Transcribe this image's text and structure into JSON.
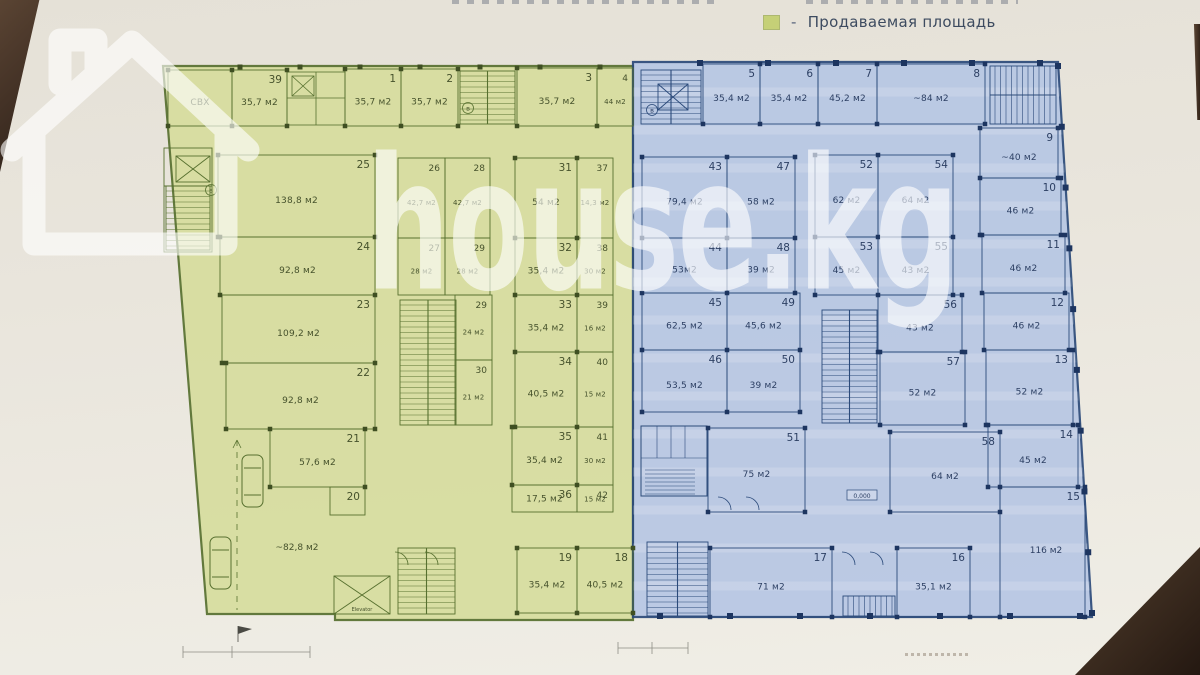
{
  "watermark": {
    "text": "house.kg"
  },
  "legend": {
    "dash": "-",
    "label": "Продаваемая площадь",
    "swatch_color": "#c5d077"
  },
  "plan": {
    "area_unit": "м2",
    "zone_colors": {
      "green_fill": "#d7dd9e",
      "green_line": "#57702f",
      "green_text": "#46522c",
      "blue_fill": "#b7c7e4",
      "blue_line": "#2b4a7a",
      "blue_text": "#2c3f63"
    },
    "rooms": [
      {
        "num": "",
        "area": "СВХ",
        "zone": "g",
        "x": 168,
        "y": 70,
        "w": 64,
        "h": 56
      },
      {
        "num": "39",
        "area": "35,7 м2",
        "zone": "g",
        "x": 232,
        "y": 70,
        "w": 55,
        "h": 56
      },
      {
        "num": "1",
        "area": "35,7 м2",
        "zone": "g",
        "x": 345,
        "y": 69,
        "w": 56,
        "h": 57
      },
      {
        "num": "2",
        "area": "35,7 м2",
        "zone": "g",
        "x": 401,
        "y": 69,
        "w": 57,
        "h": 57
      },
      {
        "num": "3",
        "area": "35,7 м2",
        "zone": "g",
        "x": 517,
        "y": 68,
        "w": 80,
        "h": 58
      },
      {
        "num": "4",
        "area": "44 м2",
        "zone": "g",
        "x": 597,
        "y": 68,
        "w": 36,
        "h": 58,
        "small": true
      },
      {
        "num": "25",
        "area": "138,8 м2",
        "zone": "g",
        "x": 218,
        "y": 155,
        "w": 157,
        "h": 82
      },
      {
        "num": "24",
        "area": "92,8 м2",
        "zone": "g",
        "x": 220,
        "y": 237,
        "w": 155,
        "h": 58
      },
      {
        "num": "23",
        "area": "109,2 м2",
        "zone": "g",
        "x": 222,
        "y": 295,
        "w": 153,
        "h": 68
      },
      {
        "num": "22",
        "area": "92,8 м2",
        "zone": "g",
        "x": 226,
        "y": 363,
        "w": 149,
        "h": 66
      },
      {
        "num": "21",
        "area": "57,6 м2",
        "zone": "g",
        "x": 270,
        "y": 429,
        "w": 95,
        "h": 58
      },
      {
        "num": "20",
        "area": "",
        "zone": "g",
        "x": 330,
        "y": 487,
        "w": 35,
        "h": 28
      },
      {
        "num": "26",
        "area": "42,7 м2",
        "zone": "g",
        "x": 398,
        "y": 158,
        "w": 47,
        "h": 80,
        "small": true
      },
      {
        "num": "28",
        "area": "42,7 м2",
        "zone": "g",
        "x": 445,
        "y": 158,
        "w": 45,
        "h": 80,
        "small": true
      },
      {
        "num": "27",
        "area": "28 м2",
        "zone": "g",
        "x": 398,
        "y": 238,
        "w": 47,
        "h": 57,
        "small": true
      },
      {
        "num": "29",
        "area": "28 м2",
        "zone": "g",
        "x": 445,
        "y": 238,
        "w": 45,
        "h": 57,
        "small": true
      },
      {
        "num": "29",
        "area": "24 м2",
        "zone": "g",
        "x": 455,
        "y": 295,
        "w": 37,
        "h": 65,
        "small": true
      },
      {
        "num": "30",
        "area": "21 м2",
        "zone": "g",
        "x": 455,
        "y": 360,
        "w": 37,
        "h": 65,
        "small": true
      },
      {
        "num": "31",
        "area": "54 м2",
        "zone": "g",
        "x": 515,
        "y": 158,
        "w": 62,
        "h": 80
      },
      {
        "num": "37",
        "area": "14,3 м2",
        "zone": "g",
        "x": 577,
        "y": 158,
        "w": 36,
        "h": 80,
        "small": true
      },
      {
        "num": "32",
        "area": "35,4 м2",
        "zone": "g",
        "x": 515,
        "y": 238,
        "w": 62,
        "h": 57
      },
      {
        "num": "38",
        "area": "30 м2",
        "zone": "g",
        "x": 577,
        "y": 238,
        "w": 36,
        "h": 57,
        "small": true
      },
      {
        "num": "33",
        "area": "35,4 м2",
        "zone": "g",
        "x": 515,
        "y": 295,
        "w": 62,
        "h": 57
      },
      {
        "num": "39",
        "area": "16 м2",
        "zone": "g",
        "x": 577,
        "y": 295,
        "w": 36,
        "h": 57,
        "small": true
      },
      {
        "num": "34",
        "area": "40,5 м2",
        "zone": "g",
        "x": 515,
        "y": 352,
        "w": 62,
        "h": 75
      },
      {
        "num": "40",
        "area": "15 м2",
        "zone": "g",
        "x": 577,
        "y": 352,
        "w": 36,
        "h": 75,
        "small": true
      },
      {
        "num": "35",
        "area": "35,4 м2",
        "zone": "g",
        "x": 512,
        "y": 427,
        "w": 65,
        "h": 58
      },
      {
        "num": "41",
        "area": "30 м2",
        "zone": "g",
        "x": 577,
        "y": 427,
        "w": 36,
        "h": 58,
        "small": true
      },
      {
        "num": "36",
        "area": "17,5 м2",
        "zone": "g",
        "x": 512,
        "y": 485,
        "w": 65,
        "h": 27
      },
      {
        "num": "42",
        "area": "15 м2",
        "zone": "g",
        "x": 577,
        "y": 485,
        "w": 36,
        "h": 27,
        "small": true
      },
      {
        "num": "19",
        "area": "35,4 м2",
        "zone": "g",
        "x": 517,
        "y": 548,
        "w": 60,
        "h": 65
      },
      {
        "num": "18",
        "area": "40,5 м2",
        "zone": "g",
        "x": 577,
        "y": 548,
        "w": 56,
        "h": 65
      },
      {
        "num": "5",
        "area": "35,4 м2",
        "zone": "b",
        "x": 703,
        "y": 64,
        "w": 57,
        "h": 60
      },
      {
        "num": "6",
        "area": "35,4 м2",
        "zone": "b",
        "x": 760,
        "y": 64,
        "w": 58,
        "h": 60
      },
      {
        "num": "7",
        "area": "45,2 м2",
        "zone": "b",
        "x": 818,
        "y": 64,
        "w": 59,
        "h": 60
      },
      {
        "num": "8",
        "area": "~84 м2",
        "zone": "b",
        "x": 877,
        "y": 64,
        "w": 108,
        "h": 60
      },
      {
        "num": "9",
        "area": "~40 м2",
        "zone": "b",
        "x": 980,
        "y": 128,
        "w": 78,
        "h": 50
      },
      {
        "num": "10",
        "area": "46 м2",
        "zone": "b",
        "x": 980,
        "y": 178,
        "w": 81,
        "h": 57
      },
      {
        "num": "11",
        "area": "46 м2",
        "zone": "b",
        "x": 982,
        "y": 235,
        "w": 83,
        "h": 58
      },
      {
        "num": "12",
        "area": "46 м2",
        "zone": "b",
        "x": 984,
        "y": 293,
        "w": 85,
        "h": 57
      },
      {
        "num": "13",
        "area": "52 м2",
        "zone": "b",
        "x": 986,
        "y": 350,
        "w": 87,
        "h": 75
      },
      {
        "num": "14",
        "area": "45 м2",
        "zone": "b",
        "x": 988,
        "y": 425,
        "w": 90,
        "h": 62
      },
      {
        "num": "15",
        "area": "",
        "zone": "b",
        "x": 1000,
        "y": 487,
        "w": 85,
        "h": 130
      },
      {
        "num": "43",
        "area": "79,4 м2",
        "zone": "b",
        "x": 642,
        "y": 157,
        "w": 85,
        "h": 81
      },
      {
        "num": "47",
        "area": "58 м2",
        "zone": "b",
        "x": 727,
        "y": 157,
        "w": 68,
        "h": 81
      },
      {
        "num": "44",
        "area": "53м2",
        "zone": "b",
        "x": 642,
        "y": 238,
        "w": 85,
        "h": 55
      },
      {
        "num": "48",
        "area": "39 м2",
        "zone": "b",
        "x": 727,
        "y": 238,
        "w": 68,
        "h": 55
      },
      {
        "num": "45",
        "area": "62,5 м2",
        "zone": "b",
        "x": 642,
        "y": 293,
        "w": 85,
        "h": 57
      },
      {
        "num": "49",
        "area": "45,6 м2",
        "zone": "b",
        "x": 727,
        "y": 293,
        "w": 73,
        "h": 57
      },
      {
        "num": "46",
        "area": "53,5 м2",
        "zone": "b",
        "x": 642,
        "y": 350,
        "w": 85,
        "h": 62
      },
      {
        "num": "50",
        "area": "39 м2",
        "zone": "b",
        "x": 727,
        "y": 350,
        "w": 73,
        "h": 62
      },
      {
        "num": "52",
        "area": "62 м2",
        "zone": "b",
        "x": 815,
        "y": 155,
        "w": 63,
        "h": 82
      },
      {
        "num": "54",
        "area": "64 м2",
        "zone": "b",
        "x": 878,
        "y": 155,
        "w": 75,
        "h": 82
      },
      {
        "num": "53",
        "area": "45 м2",
        "zone": "b",
        "x": 815,
        "y": 237,
        "w": 63,
        "h": 58
      },
      {
        "num": "55",
        "area": "43 м2",
        "zone": "b",
        "x": 878,
        "y": 237,
        "w": 75,
        "h": 58
      },
      {
        "num": "56",
        "area": "43 м2",
        "zone": "b",
        "x": 878,
        "y": 295,
        "w": 84,
        "h": 57
      },
      {
        "num": "57",
        "area": "52 м2",
        "zone": "b",
        "x": 880,
        "y": 352,
        "w": 85,
        "h": 73
      },
      {
        "num": "51",
        "area": "75 м2",
        "zone": "b",
        "x": 708,
        "y": 428,
        "w": 97,
        "h": 84
      },
      {
        "num": "58",
        "area": "64 м2",
        "zone": "b",
        "x": 890,
        "y": 432,
        "w": 110,
        "h": 80
      },
      {
        "num": "17",
        "area": "71 м2",
        "zone": "b",
        "x": 710,
        "y": 548,
        "w": 122,
        "h": 69
      },
      {
        "num": "16",
        "area": "35,1 м2",
        "zone": "b",
        "x": 897,
        "y": 548,
        "w": 73,
        "h": 69
      }
    ],
    "free_labels": [
      {
        "text": "~82,8 м2",
        "x": 297,
        "y": 550,
        "zone": "g"
      },
      {
        "text": "116 м2",
        "x": 1046,
        "y": 553,
        "zone": "b"
      }
    ],
    "level_mark": {
      "text": "0,000",
      "x": 862,
      "y": 497
    },
    "elevator_label": "Elevator",
    "circled_marks": [
      {
        "label": "в",
        "x": 211,
        "y": 190,
        "zone": "g"
      },
      {
        "label": "в",
        "x": 468,
        "y": 108,
        "zone": "g"
      },
      {
        "label": "в",
        "x": 652,
        "y": 110,
        "zone": "b"
      }
    ]
  }
}
